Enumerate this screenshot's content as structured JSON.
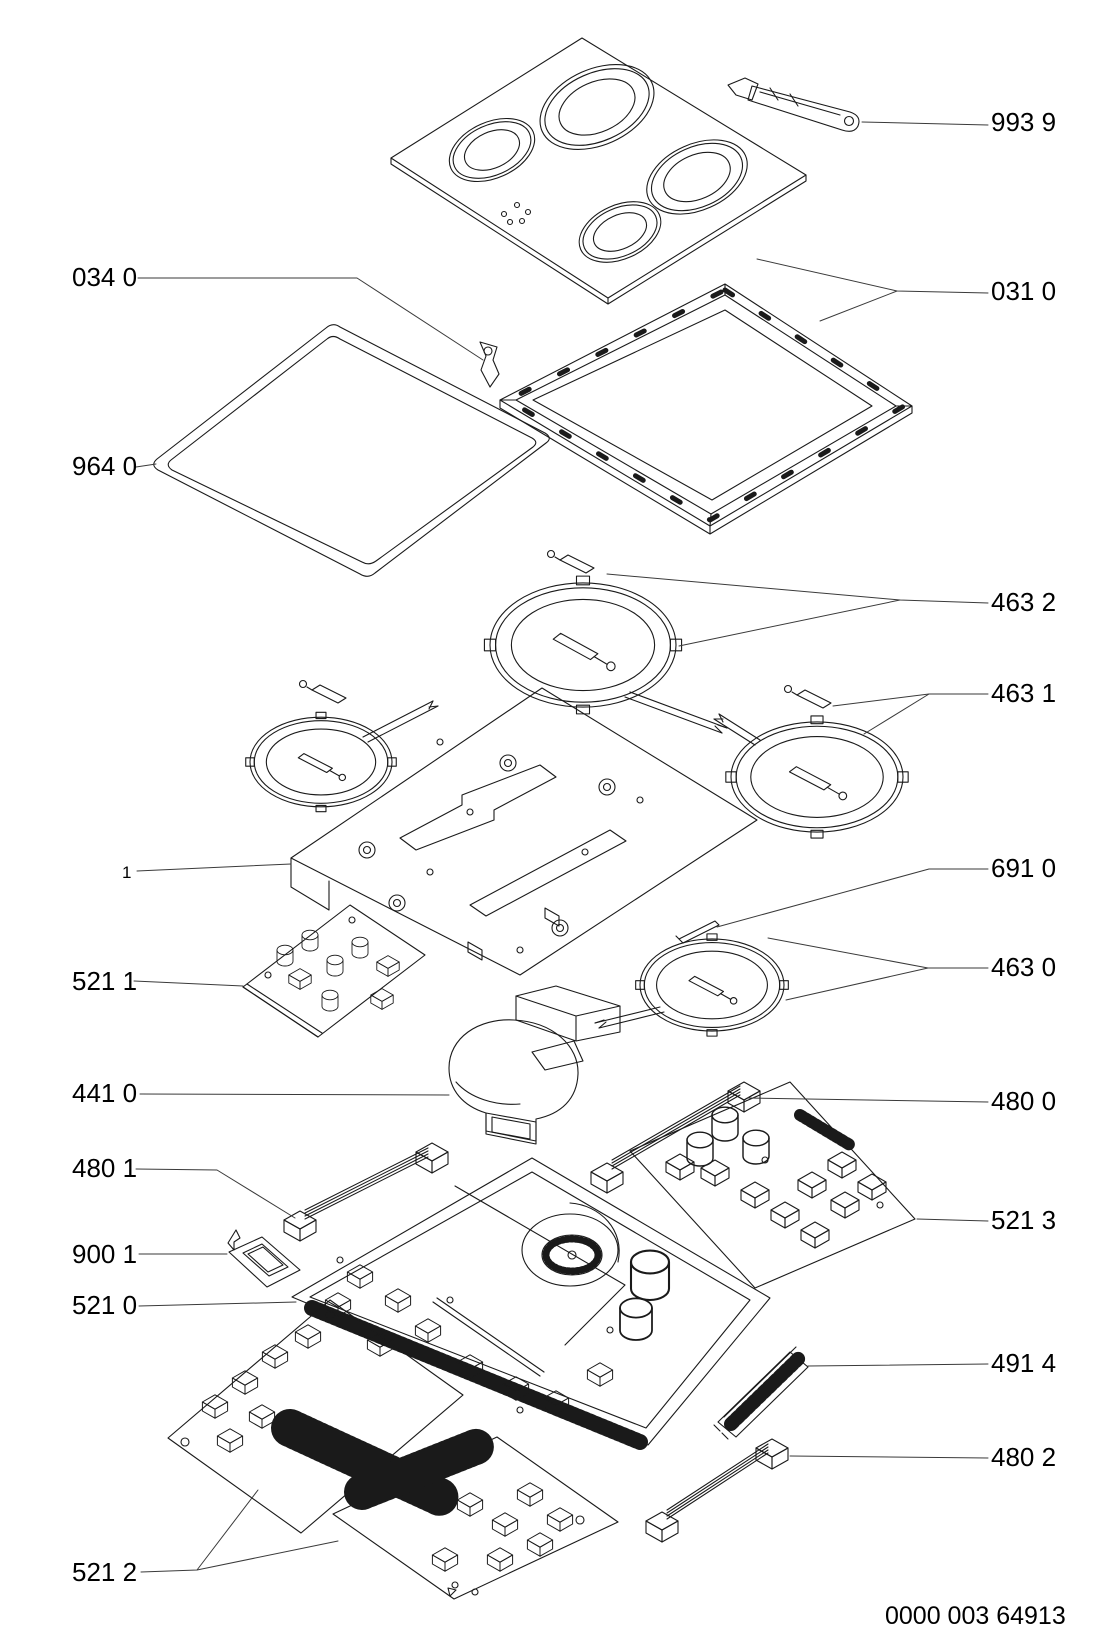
{
  "document": {
    "type": "exploded-parts-diagram",
    "product": "ceramic-induction-hob",
    "background_color": "#ffffff",
    "line_color": "#1a1a1a",
    "footer_code": "0000 003 64913"
  },
  "callouts": {
    "left": [
      {
        "code": "034 0"
      },
      {
        "code": "964 0"
      },
      {
        "code": "1"
      },
      {
        "code": "521 1"
      },
      {
        "code": "441 0"
      },
      {
        "code": "480 1"
      },
      {
        "code": "900 1"
      },
      {
        "code": "521 0"
      },
      {
        "code": "521 2"
      }
    ],
    "right": [
      {
        "code": "993 9"
      },
      {
        "code": "031 0"
      },
      {
        "code": "463 2"
      },
      {
        "code": "463 1"
      },
      {
        "code": "691 0"
      },
      {
        "code": "463 0"
      },
      {
        "code": "480 0"
      },
      {
        "code": "521 3"
      },
      {
        "code": "491 4"
      },
      {
        "code": "480 2"
      }
    ]
  }
}
